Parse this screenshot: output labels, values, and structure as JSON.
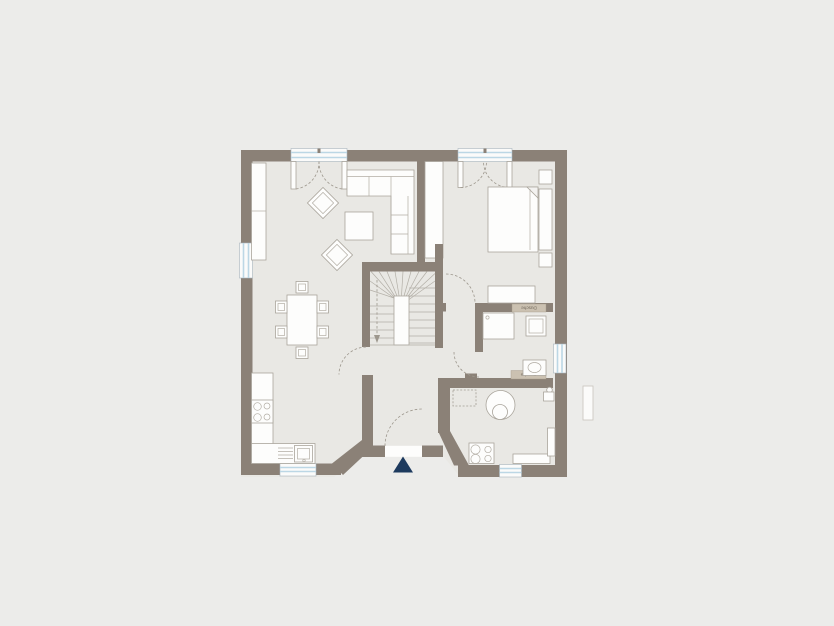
{
  "meta": {
    "type": "architectural-floor-plan",
    "description": "Single-storey house floor plan on neutral background"
  },
  "labels": {
    "shower_top": "Dusche",
    "shower_bottom": "Dusche"
  },
  "colors": {
    "background": "#ececea",
    "floor": "#e9e8e4",
    "wall": "#8b8177",
    "window_glass": "#bcd7e5",
    "closet_strip": "#cbc1b1",
    "entrance_marker": "#1d3a5e",
    "furniture_outline": "#a9a49b"
  },
  "symbols": [
    "sofa",
    "coffee-table",
    "armchair",
    "sideboard",
    "dining-table",
    "chair",
    "bed",
    "nightstand",
    "headboard",
    "dresser",
    "stairs",
    "shower",
    "wc",
    "washbasin",
    "boiler",
    "washer-dryer",
    "stove",
    "kitchen-sink",
    "kitchen-counter",
    "window",
    "door-swing",
    "entrance-arrow"
  ]
}
